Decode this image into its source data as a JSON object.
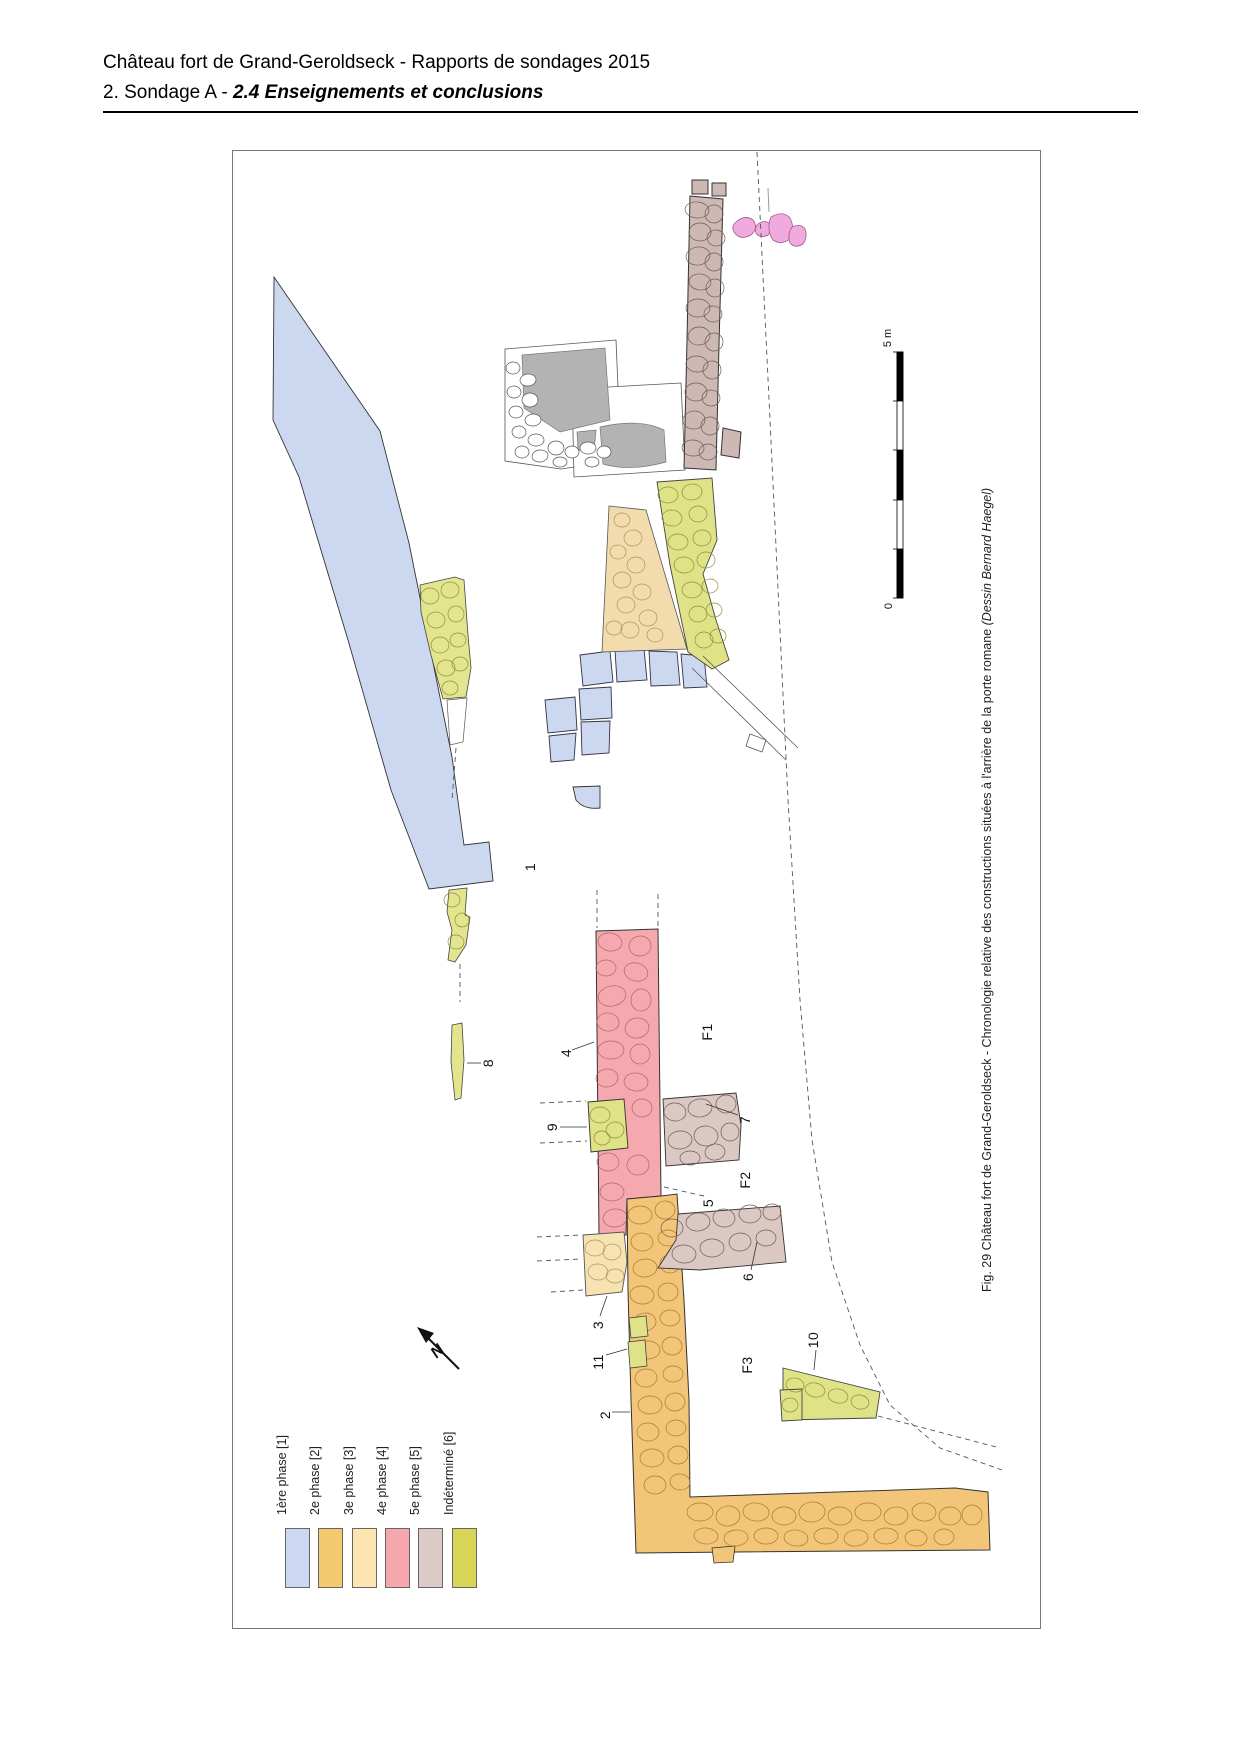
{
  "header": {
    "line1": "Château fort de Grand-Geroldseck - Rapports de sondages 2015",
    "line2_prefix": "2. Sondage A - ",
    "line2_emphasis": "2.4 Enseignements et conclusions"
  },
  "figure": {
    "caption_main": "Fig. 29 Château fort de Grand-Geroldseck - Chronologie relative des constructions situées à l'arrière de la porte romane ",
    "caption_credit": "(Dessin Bernard Haegel)",
    "scale_bar": {
      "top_label": "5 m",
      "bottom_label": "0"
    },
    "north_label": "N",
    "phase_colors": {
      "phase1_blue": "#ccd7f0",
      "phase2_orange": "#f2c579",
      "phase3_cream": "#f7e3b2",
      "phase4_pink": "#f5a9ae",
      "phase5_mauve": "#d8c4bf",
      "indetermine_green": "#dfe287"
    },
    "legend": [
      {
        "label": "1ère phase [1]",
        "color": "#ccd7f2"
      },
      {
        "label": "2e phase [2]",
        "color": "#f5c96e"
      },
      {
        "label": "3e phase [3]",
        "color": "#fce5b0"
      },
      {
        "label": "4e phase [4]",
        "color": "#f6a7ab"
      },
      {
        "label": "5e phase [5]",
        "color": "#dccac6"
      },
      {
        "label": "Indéterminé [6]",
        "color": "#d8d455"
      }
    ],
    "plan_labels": [
      {
        "text": "1",
        "x": 530,
        "y": 867
      },
      {
        "text": "8",
        "x": 488,
        "y": 1063
      },
      {
        "text": "4",
        "x": 566,
        "y": 1053
      },
      {
        "text": "9",
        "x": 552,
        "y": 1127
      },
      {
        "text": "F1",
        "x": 707,
        "y": 1032
      },
      {
        "text": "7",
        "x": 745,
        "y": 1120
      },
      {
        "text": "F2",
        "x": 745,
        "y": 1180
      },
      {
        "text": "5",
        "x": 708,
        "y": 1203
      },
      {
        "text": "6",
        "x": 748,
        "y": 1277
      },
      {
        "text": "3",
        "x": 598,
        "y": 1325
      },
      {
        "text": "11",
        "x": 598,
        "y": 1362
      },
      {
        "text": "2",
        "x": 605,
        "y": 1415
      },
      {
        "text": "F3",
        "x": 747,
        "y": 1365
      },
      {
        "text": "10",
        "x": 813,
        "y": 1340
      }
    ]
  }
}
